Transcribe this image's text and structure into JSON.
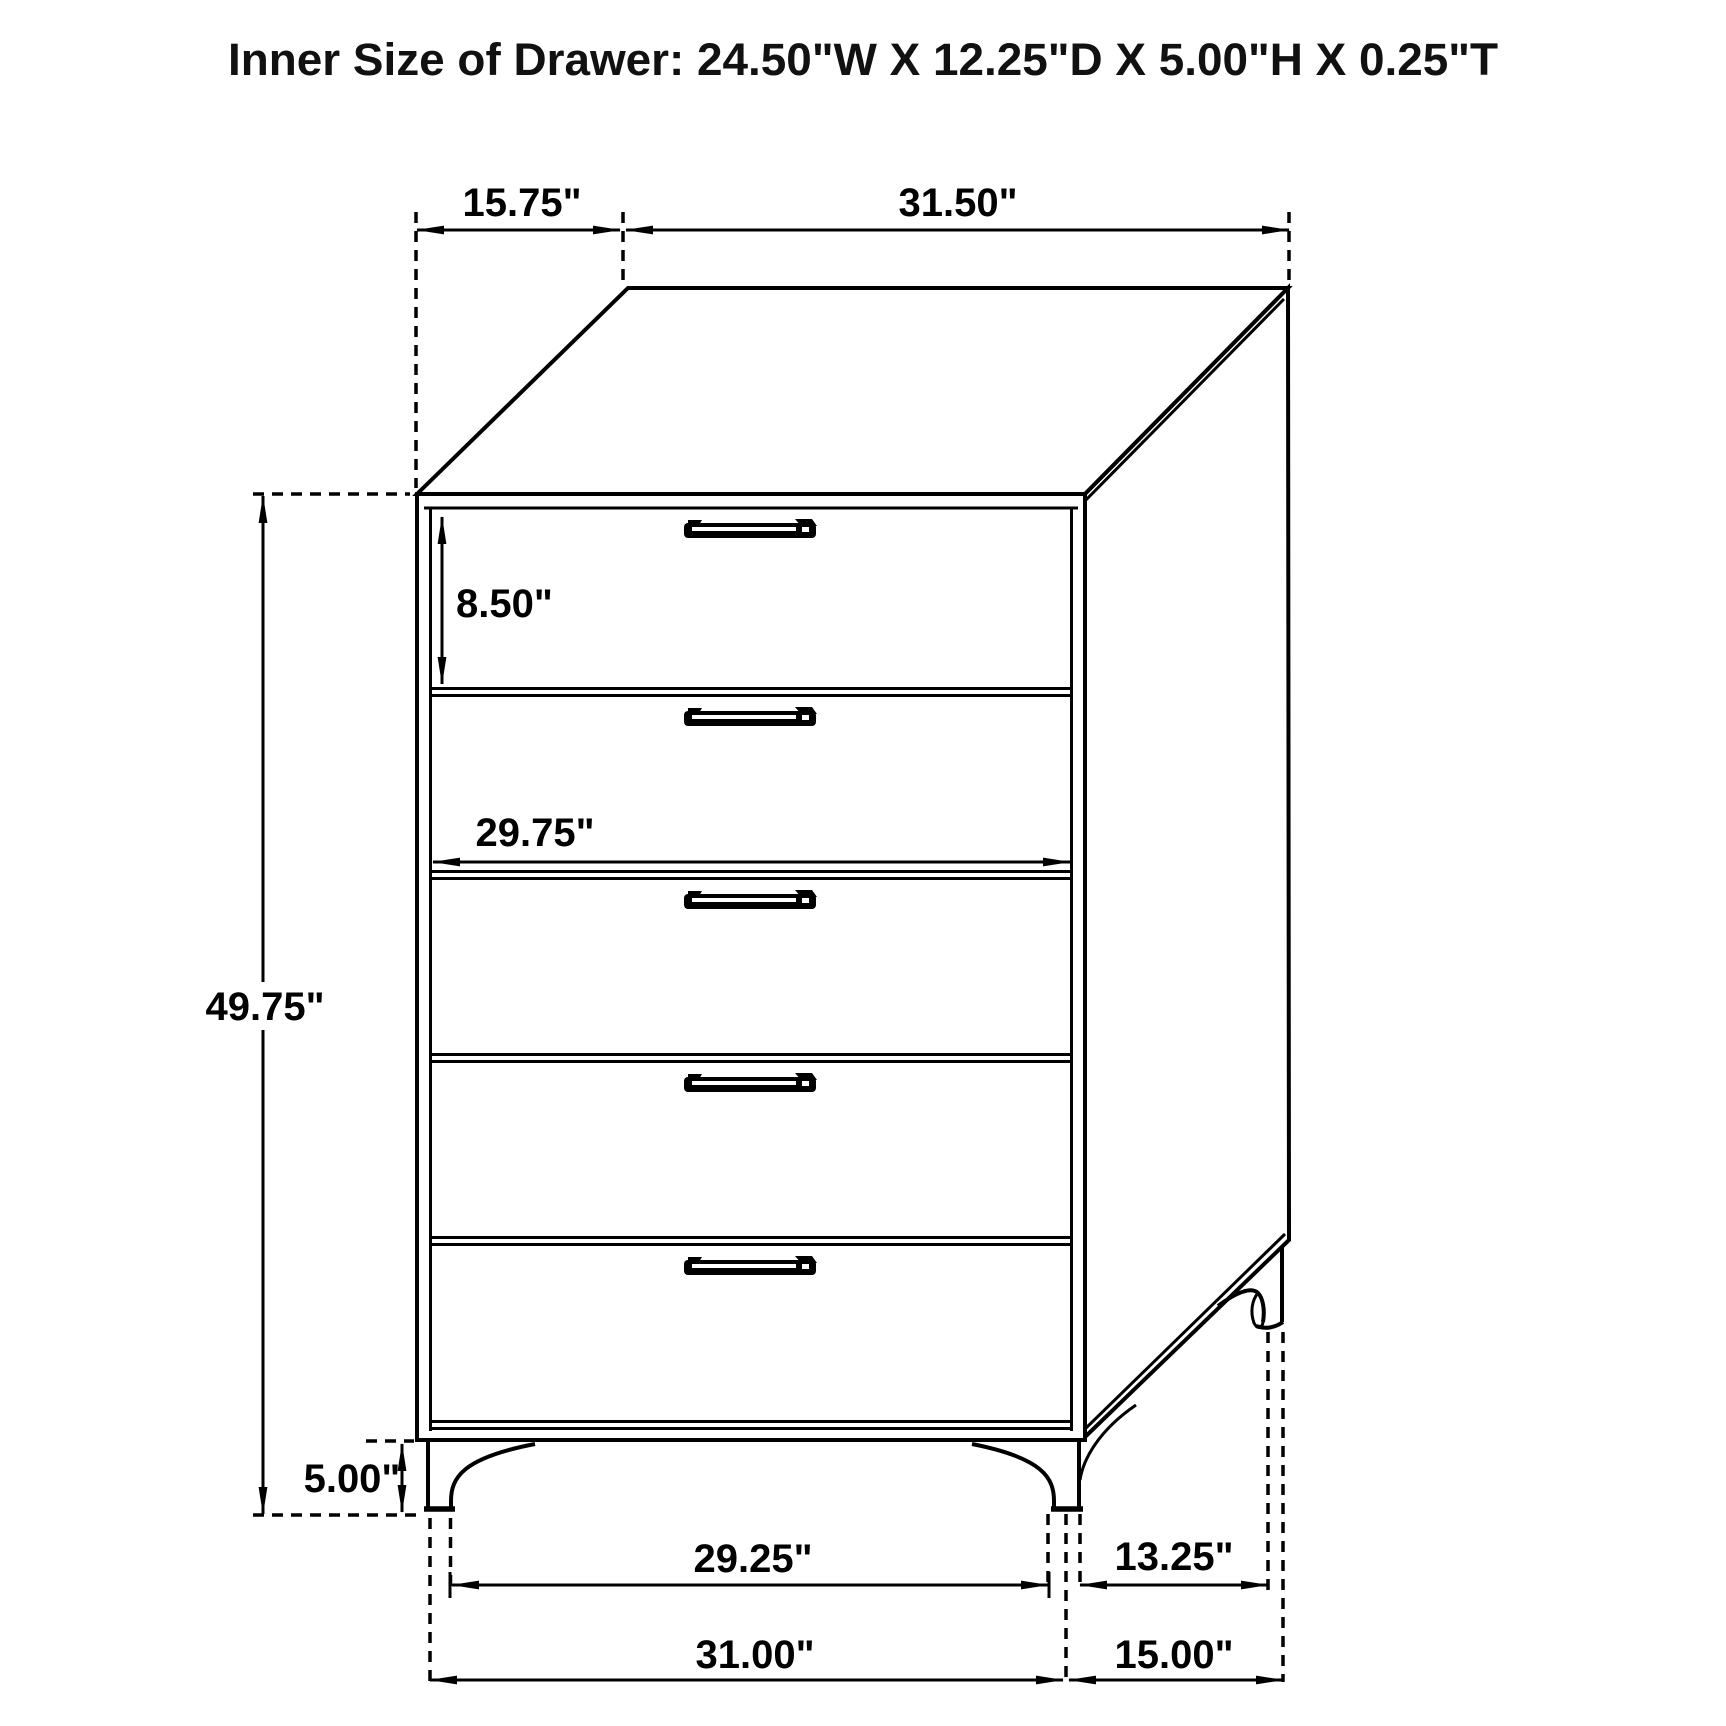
{
  "title": "Inner Size of Drawer: 24.50\"W X 12.25\"D X 5.00\"H X 0.25\"T",
  "figure": {
    "subject": "5-drawer chest dimension diagram",
    "drawer_count": 5,
    "line_color": "#000000",
    "background_color": "#ffffff",
    "text_color": "#000000"
  },
  "dims": {
    "top_depth": "15.75\"",
    "top_width": "31.50\"",
    "top_drawer_height": "8.50\"",
    "drawer_width": "29.75\"",
    "overall_height": "49.75\"",
    "leg_height": "5.00\"",
    "front_leg_inner_span": "29.25\"",
    "side_leg_span": "13.25\"",
    "base_width": "31.00\"",
    "base_depth": "15.00\""
  }
}
